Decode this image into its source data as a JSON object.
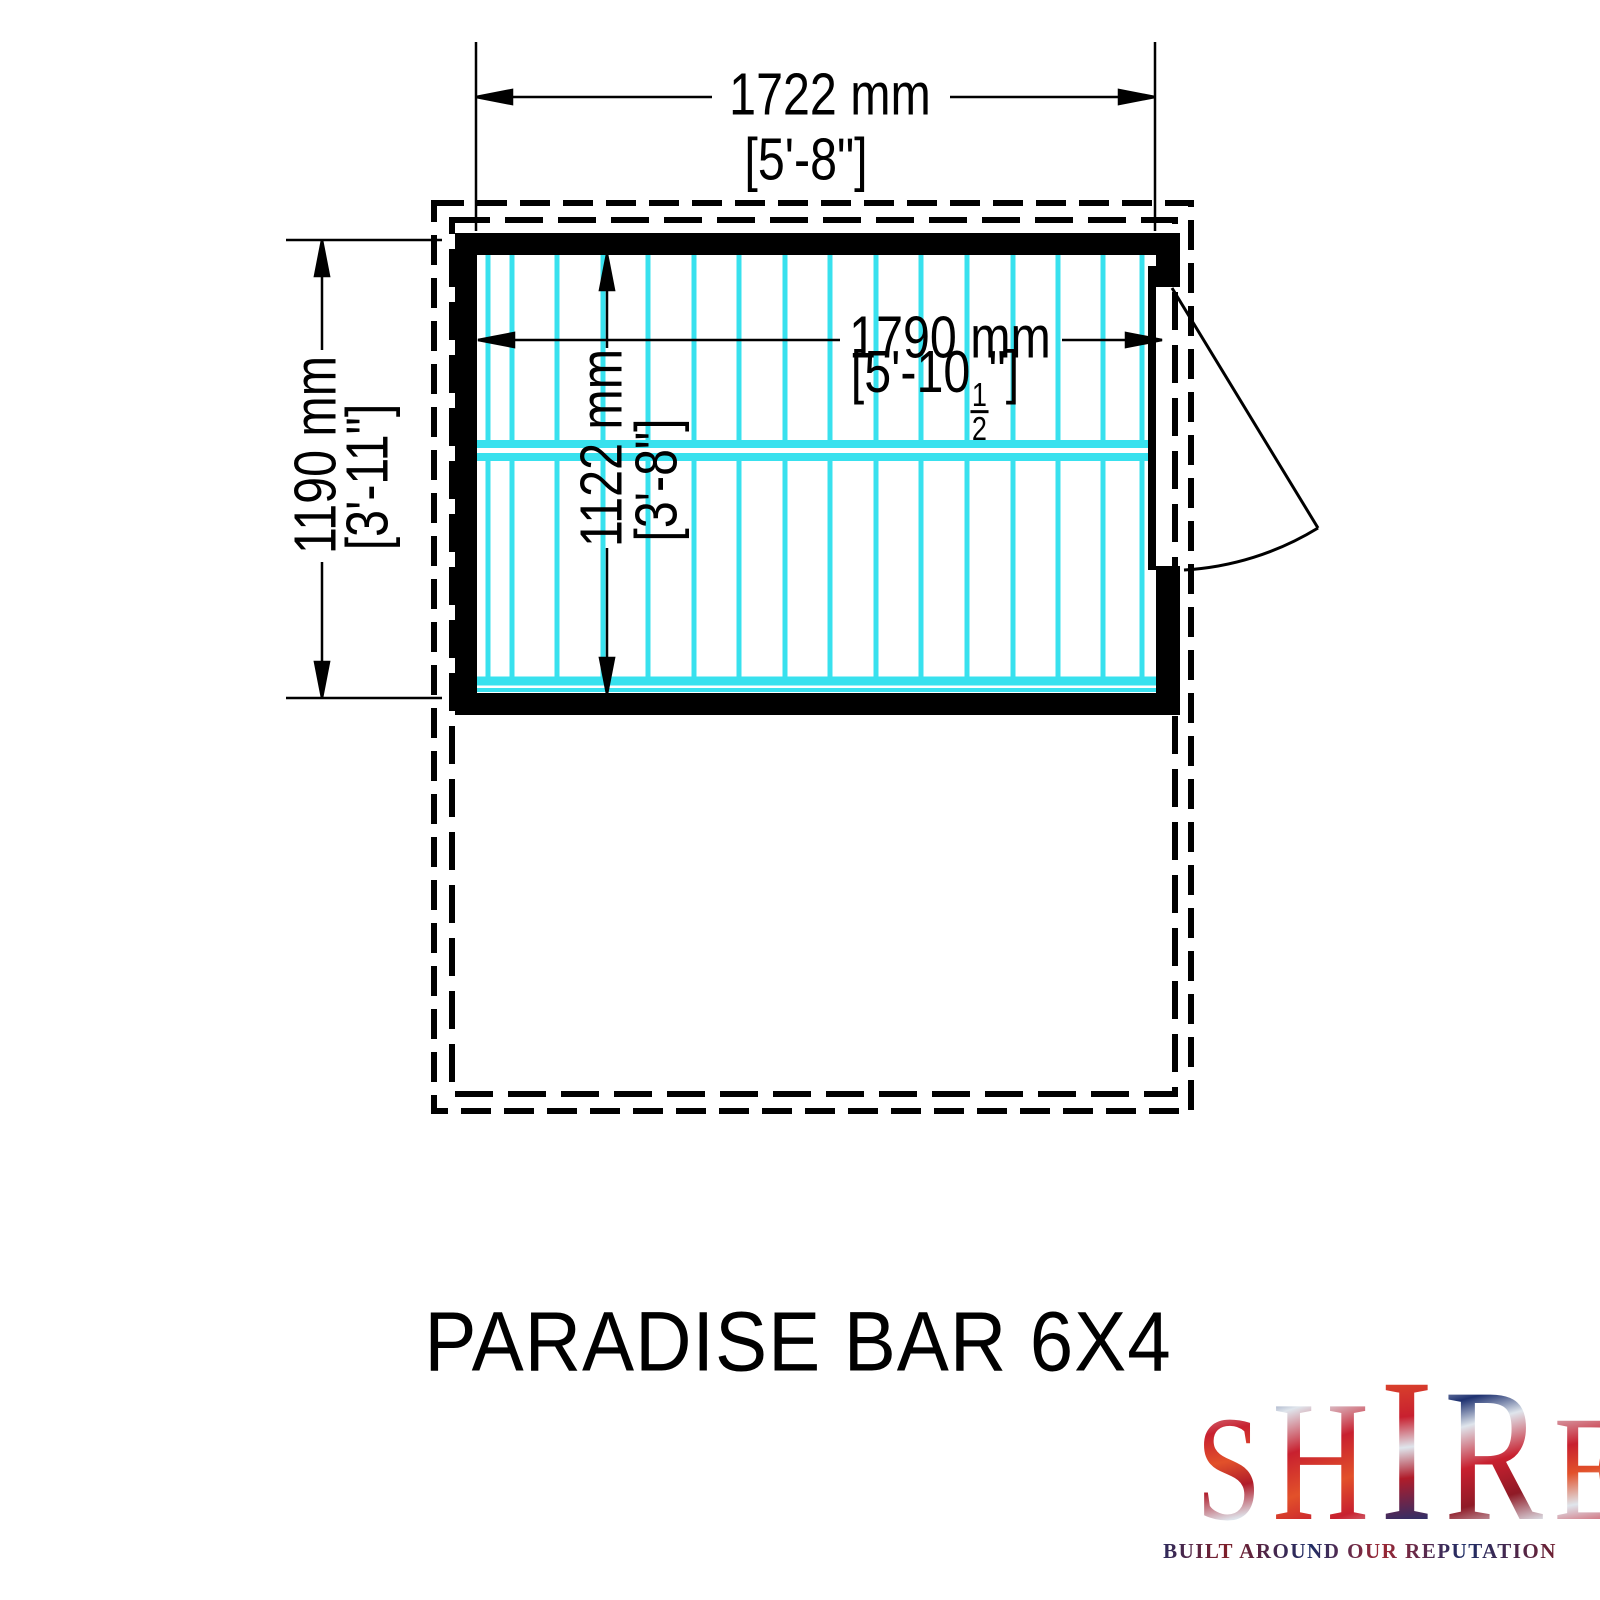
{
  "title": "PARADISE BAR 6X4",
  "logo": {
    "brand": "SHIRE",
    "letters": [
      "S",
      "H",
      "I",
      "R",
      "E"
    ],
    "tagline": "BUILT AROUND OUR REPUTATION"
  },
  "dimensions": {
    "external_width": {
      "mm": "1722 mm",
      "imperial": "[5'-8\"]"
    },
    "external_depth": {
      "mm": "1190 mm",
      "imperial": "[3'-11\"]"
    },
    "internal_width": {
      "mm": "1790 mm",
      "imperial_prefix": "[5'-10",
      "fraction_numerator": "1",
      "fraction_denominator": "2",
      "imperial_suffix": "\"]"
    },
    "internal_depth": {
      "mm": "1122 mm",
      "imperial": "[3'-8\"]"
    }
  },
  "colors": {
    "floor_boards": "#38e1ee",
    "walls": "#000000",
    "brand_navy": "#1e3170",
    "brand_red": "#c8202f"
  }
}
